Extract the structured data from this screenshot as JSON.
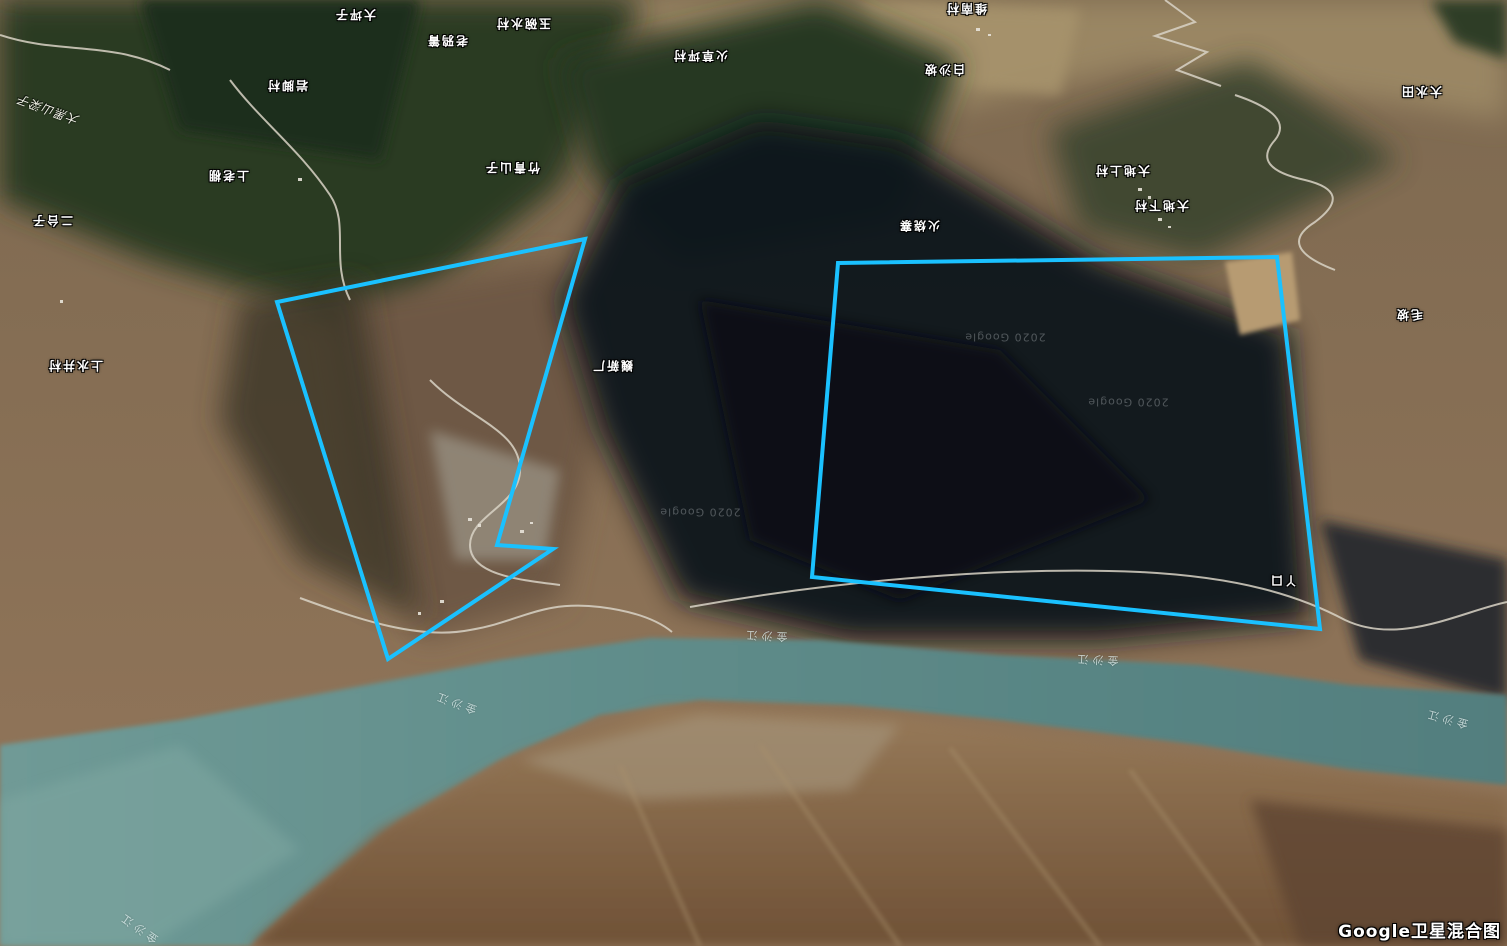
{
  "map": {
    "type_label": "Google卫星混合图",
    "overlay_color": "#1ac1ff",
    "annotations": {
      "polygons": [
        {
          "name": "left-area-outline",
          "color": "#1ac1ff",
          "stroke_width": 4,
          "points": [
            [
              585,
              239
            ],
            [
              277,
              302
            ],
            [
              388,
              659
            ],
            [
              553,
              549
            ],
            [
              497,
              545
            ]
          ]
        },
        {
          "name": "right-area-outline",
          "color": "#1ac1ff",
          "stroke_width": 4,
          "points": [
            [
              838,
              263
            ],
            [
              1277,
              257
            ],
            [
              1320,
              629
            ],
            [
              812,
              577
            ]
          ]
        }
      ]
    },
    "labels": [
      {
        "kind": "place",
        "text": "大坪子",
        "x": 355,
        "y": 15,
        "rot": 180
      },
      {
        "kind": "place",
        "text": "玉碗水村",
        "x": 523,
        "y": 24,
        "rot": 180
      },
      {
        "kind": "place",
        "text": "老鸦箐",
        "x": 447,
        "y": 41,
        "rot": 180
      },
      {
        "kind": "place",
        "text": "火草坪村",
        "x": 700,
        "y": 56,
        "rot": 180
      },
      {
        "kind": "place",
        "text": "维南村",
        "x": 966,
        "y": 9,
        "rot": 180
      },
      {
        "kind": "place",
        "text": "白沙坡",
        "x": 944,
        "y": 70,
        "rot": 180
      },
      {
        "kind": "place",
        "text": "岩脚村",
        "x": 287,
        "y": 86,
        "rot": 180
      },
      {
        "kind": "place",
        "text": "大水田",
        "x": 1421,
        "y": 92,
        "rot": 180
      },
      {
        "kind": "place",
        "text": "竹青山子",
        "x": 512,
        "y": 168,
        "rot": 180
      },
      {
        "kind": "place",
        "text": "上老棚",
        "x": 228,
        "y": 176,
        "rot": 180
      },
      {
        "kind": "place",
        "text": "大地上村",
        "x": 1122,
        "y": 171,
        "rot": 180
      },
      {
        "kind": "place",
        "text": "大地下村",
        "x": 1161,
        "y": 206,
        "rot": 180
      },
      {
        "kind": "place",
        "text": "二台子",
        "x": 52,
        "y": 221,
        "rot": 180
      },
      {
        "kind": "place",
        "text": "火烧寨",
        "x": 919,
        "y": 226,
        "rot": 180
      },
      {
        "kind": "place",
        "text": "毛坡",
        "x": 1409,
        "y": 315,
        "rot": 180
      },
      {
        "kind": "place",
        "text": "巍新厂",
        "x": 612,
        "y": 366,
        "rot": 180
      },
      {
        "kind": "place",
        "text": "上水井村",
        "x": 75,
        "y": 366,
        "rot": 180
      },
      {
        "kind": "place",
        "text": "丫口",
        "x": 1283,
        "y": 581,
        "rot": 180
      },
      {
        "kind": "nature",
        "text": "大黑山梁子",
        "x": 48,
        "y": 110,
        "rot": 200
      },
      {
        "kind": "river",
        "text": "金沙江",
        "x": 455,
        "y": 703,
        "rot": 200
      },
      {
        "kind": "river",
        "text": "金沙江",
        "x": 765,
        "y": 636,
        "rot": 183
      },
      {
        "kind": "river",
        "text": "金沙江",
        "x": 1096,
        "y": 660,
        "rot": 183
      },
      {
        "kind": "river",
        "text": "金沙江",
        "x": 1446,
        "y": 719,
        "rot": 195
      },
      {
        "kind": "river",
        "text": "金沙江",
        "x": 138,
        "y": 928,
        "rot": 215
      },
      {
        "kind": "watermark",
        "text": "2020 Google",
        "x": 1005,
        "y": 337,
        "rot": 180
      },
      {
        "kind": "watermark",
        "text": "2020 Google",
        "x": 1128,
        "y": 402,
        "rot": 180
      },
      {
        "kind": "watermark",
        "text": "2020 Google",
        "x": 700,
        "y": 512,
        "rot": 180
      }
    ]
  }
}
